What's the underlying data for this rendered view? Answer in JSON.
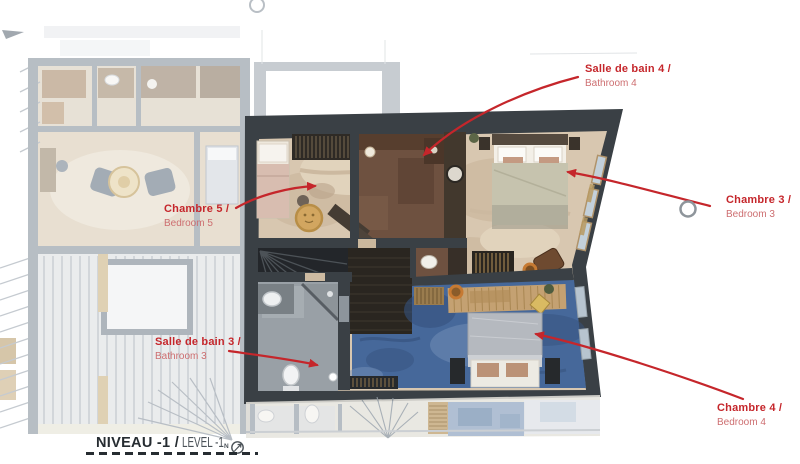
{
  "page": {
    "background": "#ffffff",
    "type": "architectural floor plan"
  },
  "annotations": {
    "bathroom4": {
      "fr": "Salle de bain 4 /",
      "en": "Bathroom 4"
    },
    "bedroom5": {
      "fr": "Chambre 5 /",
      "en": "Bedroom 5"
    },
    "bedroom3": {
      "fr": "Chambre 3 /",
      "en": "Bedroom 3"
    },
    "bathroom3": {
      "fr": "Salle de bain 3 /",
      "en": "Bathroom 3"
    },
    "bedroom4": {
      "fr": "Chambre 4 /",
      "en": "Bedroom 4"
    }
  },
  "title": {
    "fr": "NIVEAU -1 /",
    "en": "LEVEL -1",
    "compass_sub": "N"
  },
  "icons": {
    "north_arrow": "north-arrow-icon"
  },
  "colors": {
    "accent_red": "#c5262b",
    "accent_red_light": "#cd6e70",
    "wall_dark": "#3a4045",
    "floor_beige": "#d8c7b0",
    "floor_brown": "#6e5140",
    "floor_blue": "#46689a",
    "floor_gray": "#99a0a6",
    "floor_wood": "#c4a172",
    "title_dark": "#262c31",
    "title_gray": "#4b5258"
  }
}
